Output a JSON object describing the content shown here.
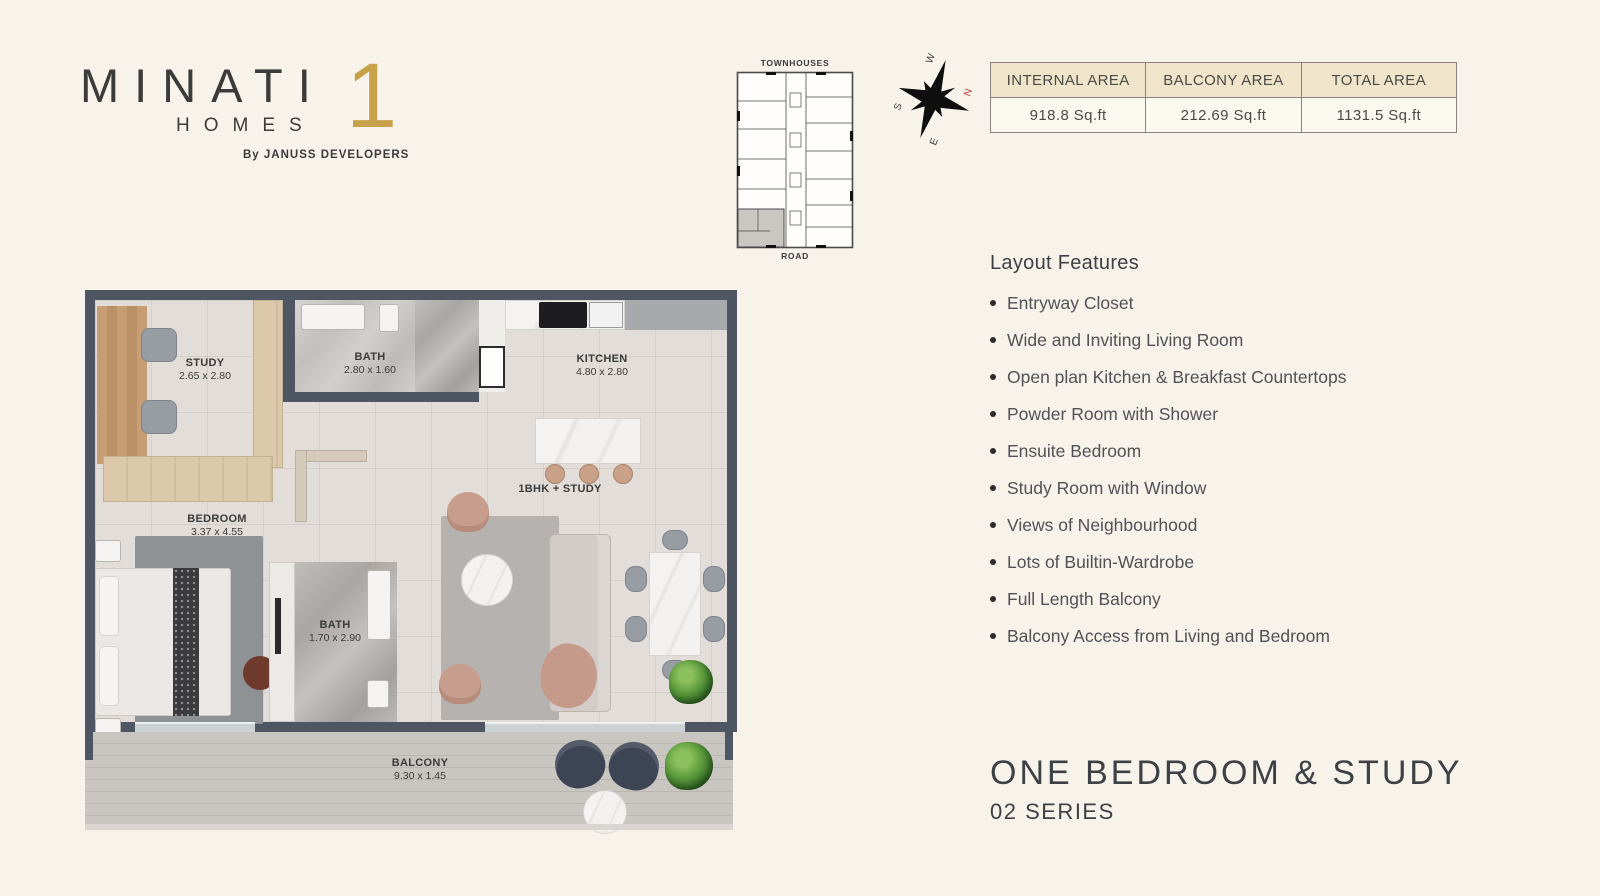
{
  "logo": {
    "brand": "MINATI",
    "numeral": "1",
    "word": "HOMES",
    "byline": "By JANUSS DEVELOPERS"
  },
  "key_plan": {
    "top_label": "TOWNHOUSES",
    "bottom_label": "ROAD"
  },
  "compass": {
    "n": "N",
    "e": "E",
    "s": "S",
    "w": "W"
  },
  "area_table": {
    "headers": [
      "INTERNAL AREA",
      "BALCONY AREA",
      "TOTAL AREA"
    ],
    "values": [
      "918.8 Sq.ft",
      "212.69 Sq.ft",
      "1131.5 Sq.ft"
    ]
  },
  "features": {
    "title": "Layout Features",
    "items": [
      "Entryway Closet",
      "Wide and Inviting Living Room",
      "Open plan Kitchen & Breakfast Countertops",
      "Powder Room with Shower",
      "Ensuite Bedroom",
      "Study Room with Window",
      "Views of Neighbourhood",
      "Lots of Builtin-Wardrobe",
      "Full Length Balcony",
      "Balcony Access from Living and Bedroom"
    ]
  },
  "floor_plan": {
    "rooms": {
      "study": {
        "name": "STUDY",
        "dims": "2.65 x 2.80"
      },
      "bath_top": {
        "name": "BATH",
        "dims": "2.80 x 1.60"
      },
      "kitchen": {
        "name": "KITCHEN",
        "dims": "4.80 x 2.80"
      },
      "bedroom": {
        "name": "BEDROOM",
        "dims": "3.37 x 4.55"
      },
      "bath_ensuite": {
        "name": "BATH",
        "dims": "1.70 x 2.90"
      },
      "living": {
        "name": "1BHK + STUDY"
      },
      "balcony": {
        "name": "BALCONY",
        "dims": "9.30 x 1.45"
      }
    }
  },
  "unit": {
    "title": "ONE BEDROOM & STUDY",
    "series": "02 SERIES"
  },
  "colors": {
    "accent_gold": "#c8a24a",
    "wall": "#4e5663",
    "north_red": "#c0392b",
    "table_header_bg": "#f0e5cb"
  }
}
